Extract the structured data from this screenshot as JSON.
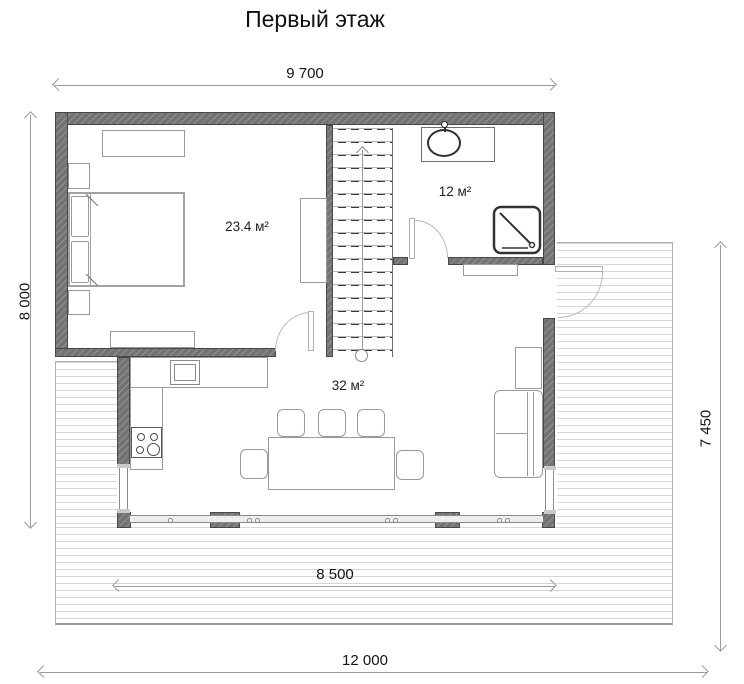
{
  "title": "Первый этаж",
  "dimensions": {
    "width_top": "9 700",
    "height_left": "8 000",
    "height_right": "7 450",
    "width_terrace": "8 500",
    "width_total": "12 000"
  },
  "rooms": {
    "bedroom": {
      "area_label": "23.4 м²"
    },
    "bathroom": {
      "area_label": "12 м²"
    },
    "living_room": {
      "area_label": "32 м²"
    }
  },
  "colors": {
    "wall": "#737373",
    "dimension_line": "#9a9a9a",
    "text": "#141414",
    "deck_plank_line": "#d6d6d6"
  }
}
